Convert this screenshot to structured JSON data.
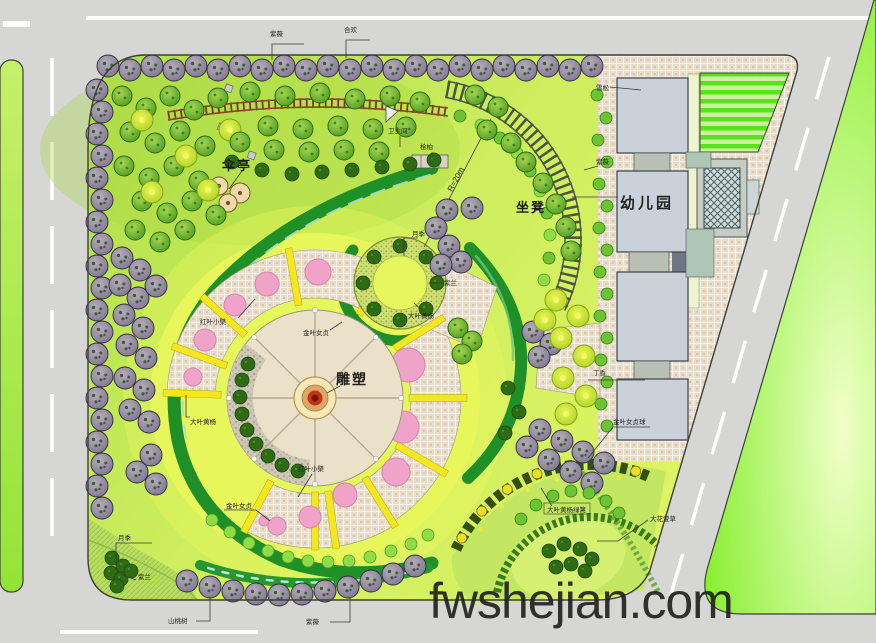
{
  "plan": {
    "watermark": "fwshejian.com",
    "feature_labels": {
      "umbrella_pavilion": "伞亭",
      "bench": "坐凳",
      "sculpture": "雕塑",
      "kindergarten": "幼儿园",
      "radius_note": "R=20m",
      "restroom": "卫生间"
    },
    "plant_labels": {
      "top_row_1": "紫薇",
      "top_row_2": "合欢",
      "juniper": "桧柏",
      "cedar": "雪松",
      "crape_myrtle_east": "紫薇",
      "rose_ne": "月季",
      "orchid_ne": "紫兰",
      "euonymus_ne": "大叶黄杨",
      "barberry_west": "红叶小檗",
      "privet_center": "金叶女贞",
      "euonymus_west": "大叶黄杨",
      "privet_south": "金叶女贞",
      "barberry_south": "红叶小檗",
      "privet_ball_se": "金叶女贞球",
      "euonymus_hedge_se": "大叶黄杨绿篱",
      "daylily_se": "大花萱草",
      "lilac_east": "丁香",
      "rose_sw": "月季",
      "orchid_sw": "紫兰",
      "peach_sw": "山桃树",
      "crape_myrtle_south": "紫薇"
    },
    "colors": {
      "background": "#d6d6d4",
      "park_green": "#c4ea55",
      "accent_green": "#8df033",
      "paving_tan": "#e7dbc9",
      "flower_pink": "#f0a3c8",
      "divider_yellow": "#f2e720",
      "hedge_dark_green": "#1f9027",
      "building_gray": "#c9d2da",
      "sculpture_red": "#c23418"
    }
  }
}
